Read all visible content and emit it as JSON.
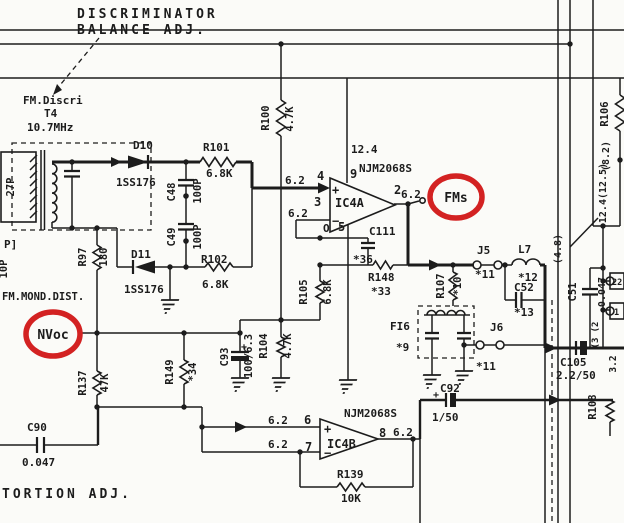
{
  "colors": {
    "ink": "#1c1c1c",
    "highlight_red": "#d32222",
    "paper": "#fbfbf8"
  },
  "highlights": {
    "fms": "FMs",
    "nvoc": "NVoc"
  },
  "labels": [
    {
      "id": "discriminator-title",
      "t": "DISCRIMINATOR",
      "x": 77,
      "y": 18,
      "s": 13,
      "ls": 3
    },
    {
      "id": "balance-adj",
      "t": "BALANCE ADJ.",
      "x": 77,
      "y": 34,
      "s": 13,
      "ls": 3
    },
    {
      "id": "tortion-adj",
      "t": "TORTION ADJ.",
      "x": 2,
      "y": 498,
      "s": 13,
      "ls": 3
    },
    {
      "id": "fm-discri",
      "t": "FM.Discri",
      "x": 23,
      "y": 104,
      "s": 11
    },
    {
      "id": "t4",
      "t": "T4",
      "x": 44,
      "y": 117,
      "s": 11
    },
    {
      "id": "freq",
      "t": "10.7MHz",
      "x": 27,
      "y": 131,
      "s": 11
    },
    {
      "id": "cap-27p",
      "t": "27P",
      "x": 14,
      "y": 187,
      "s": 10.5,
      "r": 1
    },
    {
      "id": "p-bracket",
      "t": "P]",
      "x": 4,
      "y": 248,
      "s": 11
    },
    {
      "id": "cap-10p",
      "t": "10P",
      "x": 7,
      "y": 269,
      "s": 10.5,
      "r": 1
    },
    {
      "id": "fm-mond-dist",
      "t": "FM.MOND.DIST.",
      "x": 2,
      "y": 300,
      "s": 10.5
    },
    {
      "id": "d10",
      "t": "D10",
      "x": 133,
      "y": 149,
      "s": 11
    },
    {
      "id": "d10-part",
      "t": "1SS176",
      "x": 116,
      "y": 186,
      "s": 11
    },
    {
      "id": "r101",
      "t": "R101",
      "x": 203,
      "y": 151,
      "s": 11
    },
    {
      "id": "r101-val",
      "t": "6.8K",
      "x": 206,
      "y": 177,
      "s": 11
    },
    {
      "id": "c48",
      "t": "C48",
      "x": 175,
      "y": 192,
      "s": 10.5,
      "r": 1
    },
    {
      "id": "c48-val",
      "t": "100P",
      "x": 201,
      "y": 191,
      "s": 10.5,
      "r": 1
    },
    {
      "id": "c49",
      "t": "C49",
      "x": 175,
      "y": 237,
      "s": 10.5,
      "r": 1
    },
    {
      "id": "c49-val",
      "t": "100P",
      "x": 201,
      "y": 237,
      "s": 10.5,
      "r": 1
    },
    {
      "id": "d11",
      "t": "D11",
      "x": 131,
      "y": 258,
      "s": 11
    },
    {
      "id": "d11-part",
      "t": "1SS176",
      "x": 124,
      "y": 293,
      "s": 11
    },
    {
      "id": "r102",
      "t": "R102",
      "x": 201,
      "y": 263,
      "s": 11
    },
    {
      "id": "r102-val",
      "t": "6.8K",
      "x": 202,
      "y": 288,
      "s": 11
    },
    {
      "id": "r97",
      "t": "R97",
      "x": 86,
      "y": 257,
      "s": 10.5,
      "r": 1
    },
    {
      "id": "r97-val",
      "t": "180",
      "x": 107,
      "y": 257,
      "s": 10.5,
      "r": 1
    },
    {
      "id": "r100",
      "t": "R100",
      "x": 269,
      "y": 118,
      "s": 10.5,
      "r": 1
    },
    {
      "id": "r100-val",
      "t": "4.7K",
      "x": 293,
      "y": 119,
      "s": 10.5,
      "r": 1
    },
    {
      "id": "v-12-4",
      "t": "12.4",
      "x": 351,
      "y": 153,
      "s": 11
    },
    {
      "id": "njm-a",
      "t": "NJM2068S",
      "x": 359,
      "y": 172,
      "s": 11,
      "b": 1
    },
    {
      "id": "pin9",
      "t": "9",
      "x": 350,
      "y": 178,
      "s": 12,
      "b": 1
    },
    {
      "id": "pin4",
      "t": "4",
      "x": 317,
      "y": 180,
      "s": 12,
      "b": 1
    },
    {
      "id": "v62-pin4",
      "t": "6.2",
      "x": 285,
      "y": 184,
      "s": 11
    },
    {
      "id": "pin3",
      "t": "3",
      "x": 314,
      "y": 206,
      "s": 12,
      "b": 1
    },
    {
      "id": "v62-pin3",
      "t": "6.2",
      "x": 288,
      "y": 217,
      "s": 11
    },
    {
      "id": "plus-a",
      "t": "+",
      "x": 332,
      "y": 194,
      "s": 12
    },
    {
      "id": "minus-a",
      "t": "−",
      "x": 332,
      "y": 225,
      "s": 12
    },
    {
      "id": "ic4a",
      "t": "IC4A",
      "x": 335,
      "y": 207,
      "s": 12,
      "b": 1
    },
    {
      "id": "marker-o",
      "t": "O",
      "x": 323,
      "y": 232,
      "s": 11
    },
    {
      "id": "pin5",
      "t": "5",
      "x": 338,
      "y": 231,
      "s": 12,
      "b": 1
    },
    {
      "id": "pin2",
      "t": "2",
      "x": 394,
      "y": 194,
      "s": 12,
      "b": 1
    },
    {
      "id": "v62-pin2",
      "t": "6.2",
      "x": 401,
      "y": 198,
      "s": 11
    },
    {
      "id": "c111",
      "t": "C111",
      "x": 369,
      "y": 235,
      "s": 11
    },
    {
      "id": "c111-val",
      "t": "*36",
      "x": 353,
      "y": 263,
      "s": 11
    },
    {
      "id": "r148",
      "t": "R148",
      "x": 368,
      "y": 281,
      "s": 11
    },
    {
      "id": "r148-val",
      "t": "*33",
      "x": 371,
      "y": 295,
      "s": 11
    },
    {
      "id": "r105",
      "t": "R105",
      "x": 307,
      "y": 292,
      "s": 10.5,
      "r": 1
    },
    {
      "id": "r105-val",
      "t": "6.8K",
      "x": 331,
      "y": 292,
      "s": 10.5,
      "r": 1
    },
    {
      "id": "r107",
      "t": "R107",
      "x": 444,
      "y": 286,
      "s": 10.5,
      "r": 1
    },
    {
      "id": "r107-val",
      "t": "*10",
      "x": 461,
      "y": 286,
      "s": 10.5,
      "r": 1
    },
    {
      "id": "j5",
      "t": "J5",
      "x": 477,
      "y": 254,
      "s": 11
    },
    {
      "id": "j5-val",
      "t": "*11",
      "x": 475,
      "y": 278,
      "s": 11
    },
    {
      "id": "l7",
      "t": "L7",
      "x": 518,
      "y": 253,
      "s": 11
    },
    {
      "id": "l7-val",
      "t": "*12",
      "x": 518,
      "y": 281,
      "s": 11
    },
    {
      "id": "c52",
      "t": "C52",
      "x": 514,
      "y": 291,
      "s": 11
    },
    {
      "id": "c52-val",
      "t": "*13",
      "x": 514,
      "y": 316,
      "s": 11
    },
    {
      "id": "j6",
      "t": "J6",
      "x": 490,
      "y": 331,
      "s": 11
    },
    {
      "id": "j6-val",
      "t": "*11",
      "x": 476,
      "y": 370,
      "s": 11
    },
    {
      "id": "fi6",
      "t": "FI6",
      "x": 390,
      "y": 330,
      "s": 11
    },
    {
      "id": "fi6-val",
      "t": "*9",
      "x": 396,
      "y": 351,
      "s": 11
    },
    {
      "id": "c51",
      "t": "C51",
      "x": 576,
      "y": 292,
      "s": 10.5,
      "r": 1
    },
    {
      "id": "c51-val",
      "t": "0.047",
      "x": 605,
      "y": 292,
      "s": 10,
      "r": 1
    },
    {
      "id": "v-4-8",
      "t": "(4.8)",
      "x": 561,
      "y": 249,
      "s": 10,
      "r": 1
    },
    {
      "id": "v-12-4-12-5",
      "t": "12.4(12.5)",
      "x": 606,
      "y": 193,
      "s": 10,
      "r": 1
    },
    {
      "id": "r106",
      "t": "R106",
      "x": 608,
      "y": 114,
      "s": 10.5,
      "r": 1
    },
    {
      "id": "v-8-2",
      "t": "(8.2)",
      "x": 609,
      "y": 156,
      "s": 10,
      "r": 1
    },
    {
      "id": "tab-22",
      "t": "22",
      "x": 612,
      "y": 285,
      "s": 8.5
    },
    {
      "id": "tab-1",
      "t": "1",
      "x": 614,
      "y": 315,
      "s": 8.5
    },
    {
      "id": "wire-2",
      "t": "(2",
      "x": 598,
      "y": 327,
      "s": 9,
      "r": 1
    },
    {
      "id": "wire-3",
      "t": "(3",
      "x": 598,
      "y": 343,
      "s": 9,
      "r": 1
    },
    {
      "id": "v-3-2",
      "t": "3.2",
      "x": 616,
      "y": 364,
      "s": 9.5,
      "r": 1
    },
    {
      "id": "c105",
      "t": "C105",
      "x": 560,
      "y": 366,
      "s": 11
    },
    {
      "id": "c105-val",
      "t": "2.2/50",
      "x": 556,
      "y": 379,
      "s": 11
    },
    {
      "id": "r108",
      "t": "R108",
      "x": 596,
      "y": 407,
      "s": 10.5,
      "r": 1
    },
    {
      "id": "r137",
      "t": "R137",
      "x": 86,
      "y": 383,
      "s": 10.5,
      "r": 1
    },
    {
      "id": "r137-val",
      "t": "47K",
      "x": 108,
      "y": 383,
      "s": 10.5,
      "r": 1
    },
    {
      "id": "r149",
      "t": "R149",
      "x": 173,
      "y": 372,
      "s": 10.5,
      "r": 1
    },
    {
      "id": "r149-val",
      "t": "*34",
      "x": 196,
      "y": 372,
      "s": 10.5,
      "r": 1
    },
    {
      "id": "c93",
      "t": "C93",
      "x": 228,
      "y": 357,
      "s": 10.5,
      "r": 1
    },
    {
      "id": "c93-val",
      "t": "100/6.3",
      "x": 252,
      "y": 356,
      "s": 10.5,
      "r": 1
    },
    {
      "id": "c93-plus",
      "t": "+",
      "x": 241,
      "y": 350,
      "s": 10
    },
    {
      "id": "r104",
      "t": "R104",
      "x": 267,
      "y": 346,
      "s": 10.5,
      "r": 1
    },
    {
      "id": "r104-val",
      "t": "4.7K",
      "x": 291,
      "y": 346,
      "s": 10.5,
      "r": 1
    },
    {
      "id": "c90",
      "t": "C90",
      "x": 27,
      "y": 431,
      "s": 11
    },
    {
      "id": "c90-val",
      "t": "0.047",
      "x": 22,
      "y": 466,
      "s": 11
    },
    {
      "id": "njm-b",
      "t": "NJM2068S",
      "x": 344,
      "y": 417,
      "s": 11,
      "b": 1
    },
    {
      "id": "pin6",
      "t": "6",
      "x": 304,
      "y": 424,
      "s": 12,
      "b": 1
    },
    {
      "id": "v62-pin6",
      "t": "6.2",
      "x": 268,
      "y": 424,
      "s": 11
    },
    {
      "id": "pin7",
      "t": "7",
      "x": 305,
      "y": 451,
      "s": 12,
      "b": 1
    },
    {
      "id": "v62-pin7",
      "t": "6.2",
      "x": 268,
      "y": 448,
      "s": 11
    },
    {
      "id": "pin8",
      "t": "8",
      "x": 379,
      "y": 437,
      "s": 12,
      "b": 1
    },
    {
      "id": "v62-pin8",
      "t": "6.2",
      "x": 393,
      "y": 436,
      "s": 11
    },
    {
      "id": "ic4b",
      "t": "IC4B",
      "x": 327,
      "y": 448,
      "s": 12,
      "b": 1
    },
    {
      "id": "plus-b",
      "t": "+",
      "x": 324,
      "y": 433,
      "s": 12
    },
    {
      "id": "minus-b",
      "t": "−",
      "x": 324,
      "y": 457,
      "s": 12
    },
    {
      "id": "r139",
      "t": "R139",
      "x": 337,
      "y": 478,
      "s": 11
    },
    {
      "id": "r139-val",
      "t": "10K",
      "x": 341,
      "y": 502,
      "s": 11
    },
    {
      "id": "c92",
      "t": "C92",
      "x": 440,
      "y": 392,
      "s": 11
    },
    {
      "id": "c92-plus",
      "t": "+",
      "x": 433,
      "y": 398,
      "s": 10
    },
    {
      "id": "c92-val",
      "t": "1/50",
      "x": 432,
      "y": 421,
      "s": 11
    }
  ]
}
